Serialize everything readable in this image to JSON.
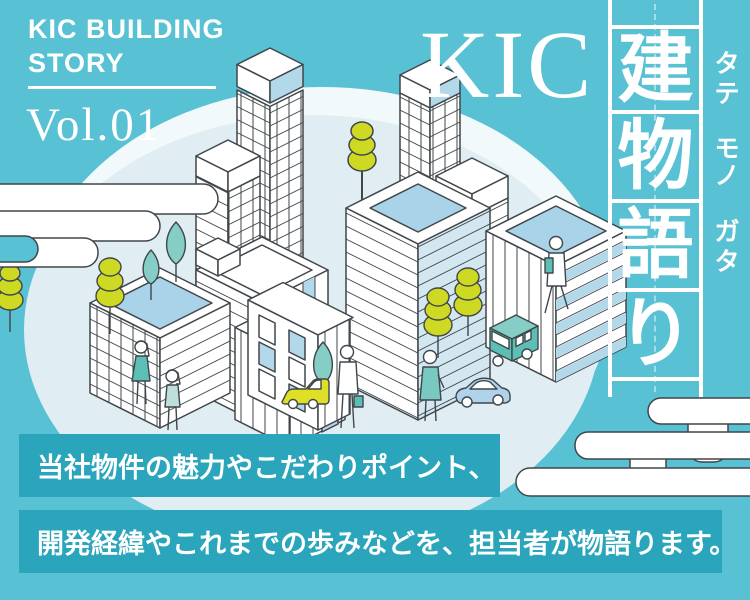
{
  "banner": {
    "series_title": "KIC BUILDING\nSTORY",
    "volume": "Vol.01",
    "title_latin": "KIC",
    "title_kanji": [
      "建",
      "物",
      "語",
      "り"
    ],
    "furigana": [
      "タ",
      "テ",
      "モ",
      "ノ",
      "ガ",
      "タ"
    ],
    "furigana_reading": "タテ モノ ガタ",
    "caption_line1": "当社物件の魅力やこだわりポイント、",
    "caption_line2": "開発経緯やこれまでの歩みなどを、担当者が物語ります。"
  },
  "colors": {
    "background_teal": "#58c1d3",
    "caption_bar_teal": "#2aa5bb",
    "circle_pale_blue": "#e0eef3",
    "circle_rim_white": "#f2f9fb",
    "line_outline": "#40464a",
    "window_blue": "#b3d8ea",
    "roof_blue": "#a9d3e8",
    "accent_teal_green": "#5bbfb5",
    "tree_teal_light": "#85cec5",
    "tree_yellow_green": "#cdd922",
    "text_white": "#ffffff"
  },
  "illustration": {
    "description": "Isometric line-art city on pale ellipse with egasumi clouds",
    "elements": [
      "office-towers",
      "apartment-buildings",
      "yellow-green-trees",
      "teal-trees",
      "bus",
      "cars",
      "pedestrians",
      "japanese-mist-clouds"
    ]
  }
}
